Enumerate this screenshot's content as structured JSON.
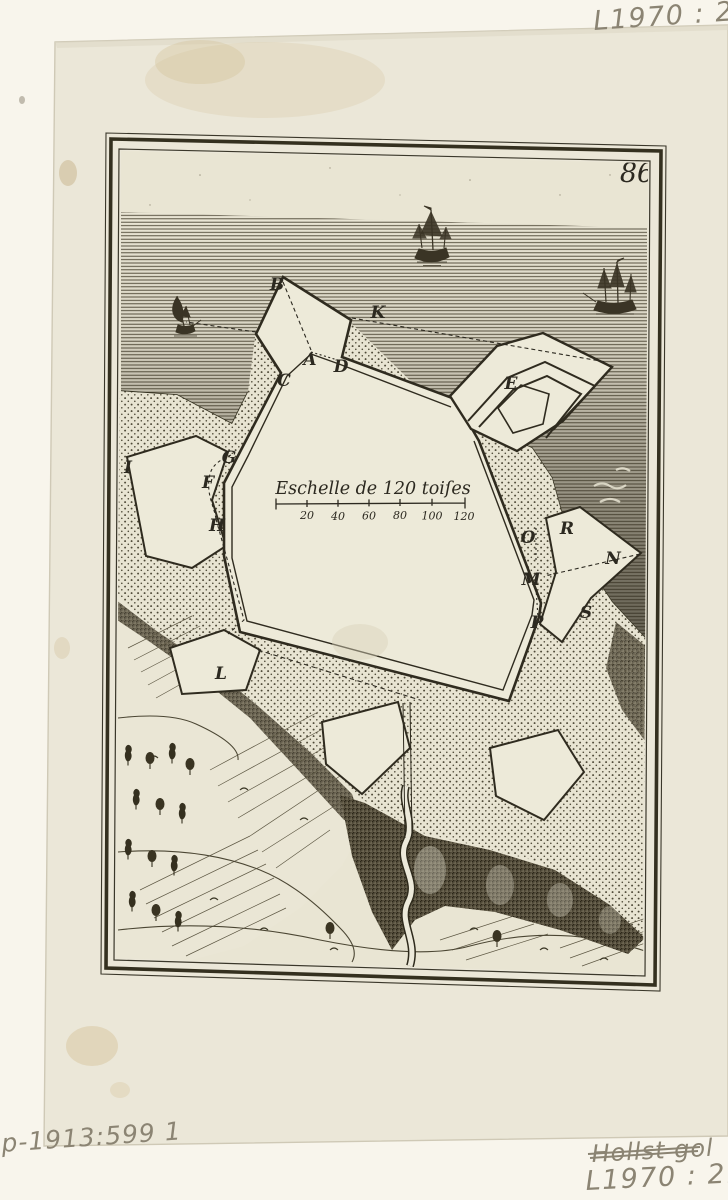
{
  "inscriptions": {
    "top_right": "L1970 : 21",
    "bottom_right_struck": "Hollst gol",
    "bottom_right": "L1970 : 21",
    "bottom_left": "-p-1913:599 1"
  },
  "print": {
    "plate_number": "86",
    "scale": {
      "title": "Eschelle de 120 toiſes",
      "ticks": [
        "20",
        "40",
        "60",
        "80",
        "100",
        "120"
      ]
    },
    "fort_labels": [
      "B",
      "K",
      "A",
      "D",
      "C",
      "E",
      "G",
      "F",
      "H",
      "I",
      "L",
      "O",
      "R",
      "N",
      "M",
      "S",
      "P"
    ],
    "colors": {
      "paper": "#ebe7d8",
      "backing": "#f8f5ec",
      "ink": "#2c2920",
      "handwriting": "#8b8473"
    }
  }
}
